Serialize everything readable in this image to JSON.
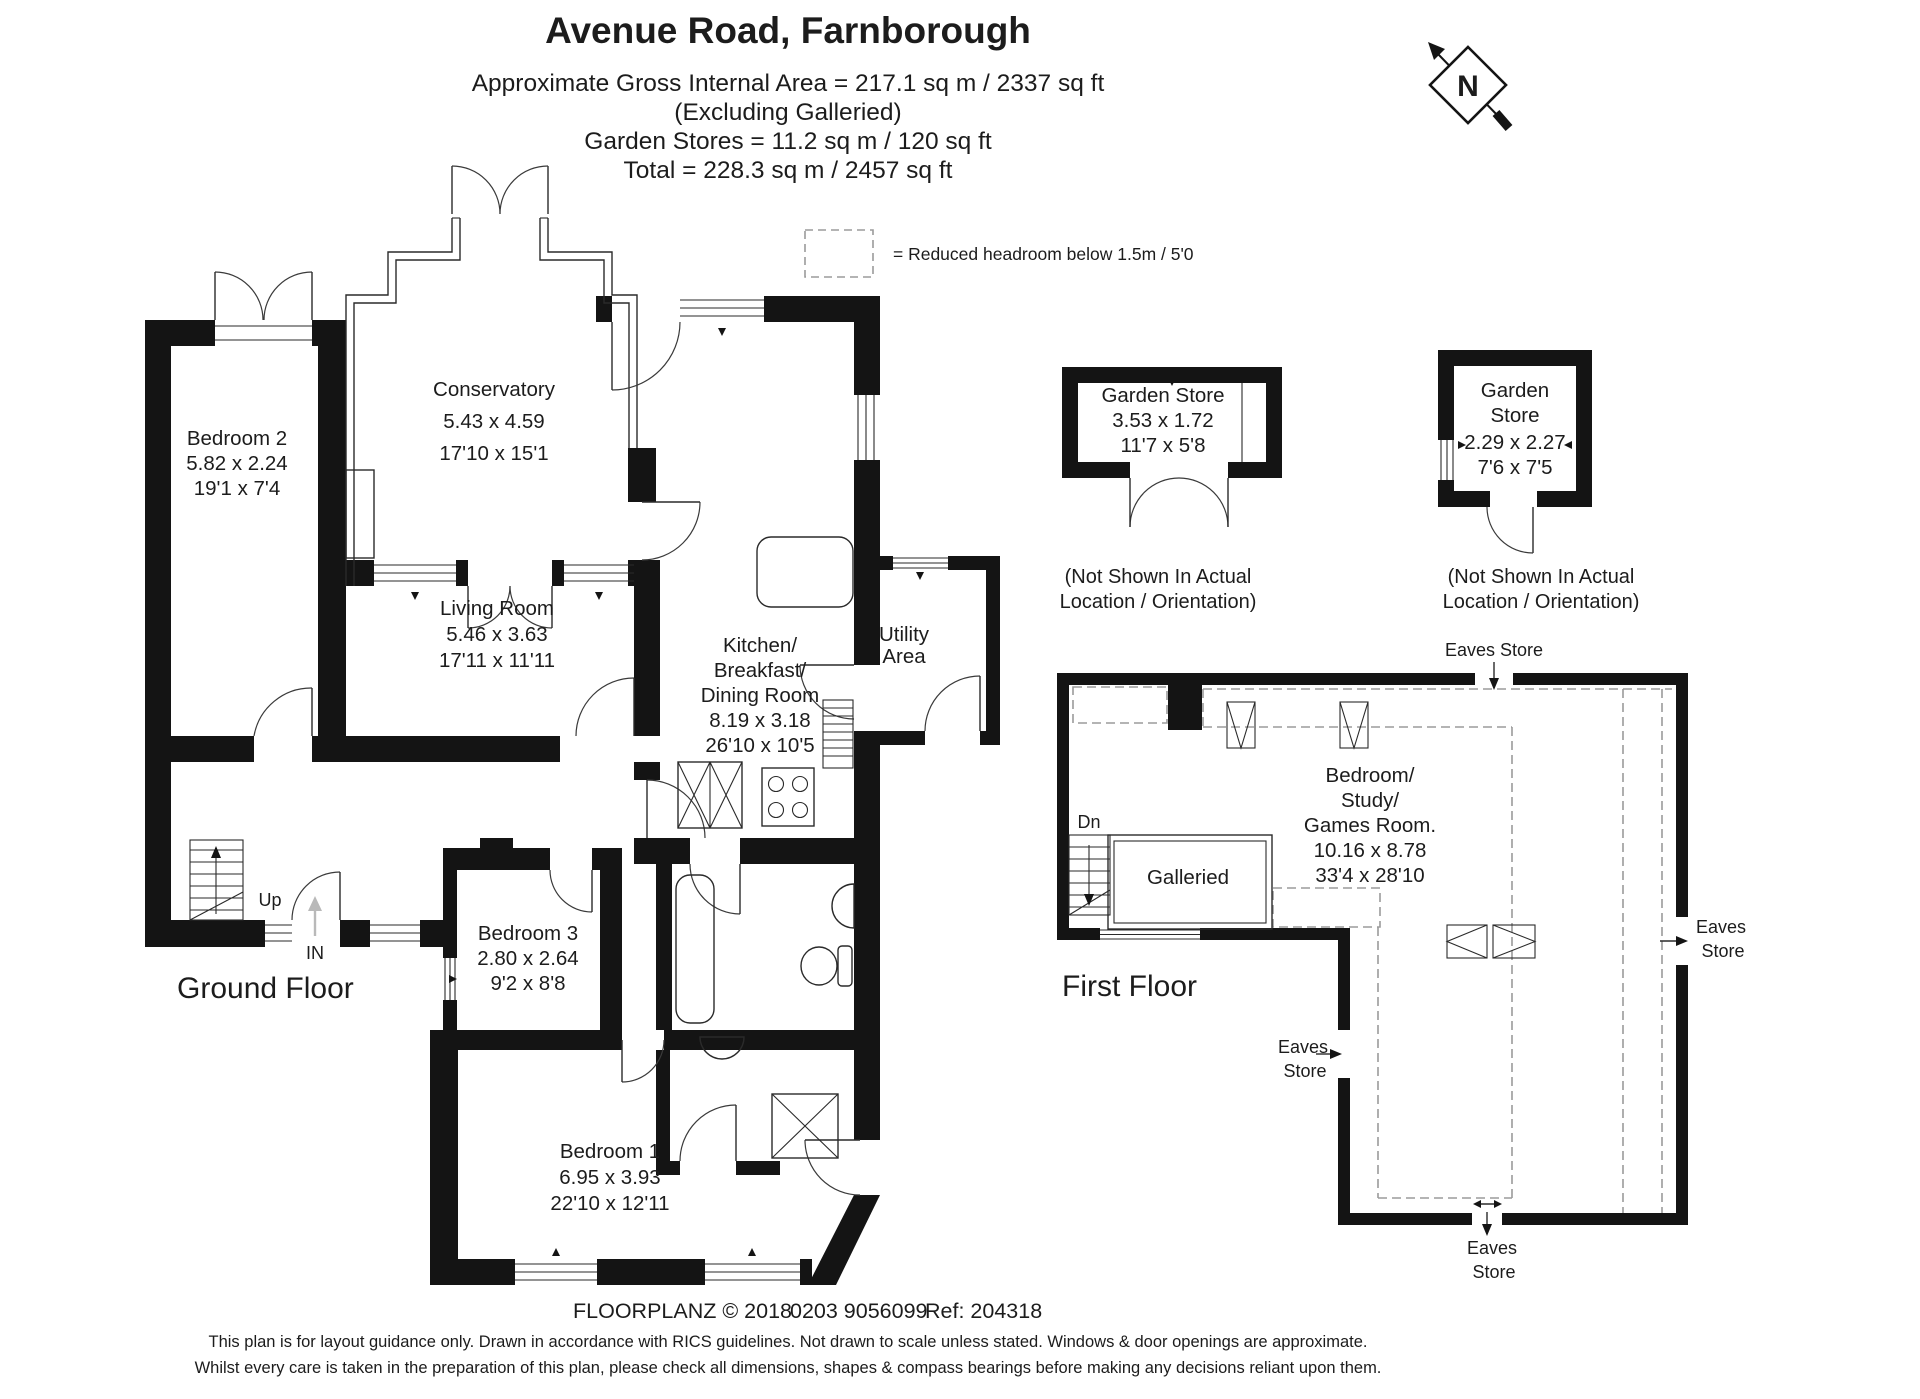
{
  "title_block": {
    "address": "Avenue Road, Farnborough",
    "area_line1": "Approximate Gross Internal Area = 217.1 sq m / 2337 sq ft",
    "area_line2": "(Excluding Galleried)",
    "area_line3": "Garden Stores = 11.2 sq m / 120 sq ft",
    "area_line4": "Total = 228.3 sq m / 2457 sq ft"
  },
  "legend": {
    "text": "= Reduced headroom below 1.5m / 5'0"
  },
  "compass": {
    "north_label": "N"
  },
  "ground_floor": {
    "floor_label": "Ground Floor",
    "up_label": "Up",
    "in_label": "IN",
    "rooms": {
      "conservatory": {
        "name": "Conservatory",
        "metric": "5.43 x 4.59",
        "imperial": "17'10 x 15'1"
      },
      "bedroom2": {
        "name": "Bedroom 2",
        "metric": "5.82 x 2.24",
        "imperial": "19'1 x 7'4"
      },
      "living_room": {
        "name": "Living Room",
        "metric": "5.46 x 3.63",
        "imperial": "17'11 x 11'11"
      },
      "kitchen": {
        "name_line1": "Kitchen/",
        "name_line2": "Breakfast/",
        "name_line3": "Dining Room",
        "metric": "8.19 x 3.18",
        "imperial": "26'10 x 10'5"
      },
      "utility": {
        "name_line1": "Utility",
        "name_line2": "Area"
      },
      "bedroom3": {
        "name": "Bedroom 3",
        "metric": "2.80 x 2.64",
        "imperial": "9'2 x 8'8"
      },
      "bedroom1": {
        "name": "Bedroom 1",
        "metric": "6.95 x 3.93",
        "imperial": "22'10 x 12'11"
      }
    }
  },
  "garden_stores": {
    "store1": {
      "name": "Garden Store",
      "metric": "3.53 x 1.72",
      "imperial": "11'7 x 5'8",
      "caption_line1": "(Not Shown In Actual",
      "caption_line2": "Location / Orientation)"
    },
    "store2": {
      "name_line1": "Garden",
      "name_line2": "Store",
      "metric": "2.29 x 2.27",
      "imperial": "7'6 x 7'5",
      "caption_line1": "(Not Shown In Actual",
      "caption_line2": "Location / Orientation)"
    }
  },
  "first_floor": {
    "floor_label": "First Floor",
    "dn_label": "Dn",
    "galleried_label": "Galleried",
    "room": {
      "name_line1": "Bedroom/",
      "name_line2": "Study/",
      "name_line3": "Games Room.",
      "metric": "10.16 x 8.78",
      "imperial": "33'4 x 28'10"
    },
    "eaves_top": "Eaves Store",
    "eaves_right_line1": "Eaves",
    "eaves_right_line2": "Store",
    "eaves_left_line1": "Eaves",
    "eaves_left_line2": "Store",
    "eaves_bottom_line1": "Eaves",
    "eaves_bottom_line2": "Store"
  },
  "footer": {
    "credit_part1": "FLOORPLANZ © 2018",
    "credit_part2": "0203 9056099",
    "credit_part3": "Ref: 204318",
    "disclaimer_line1": "This plan is for layout guidance only. Drawn in accordance with RICS guidelines. Not drawn to scale unless stated. Windows & door openings are approximate.",
    "disclaimer_line2": "Whilst every care is taken in the preparation of this plan, please check all dimensions, shapes & compass bearings before making any decisions reliant upon them."
  }
}
